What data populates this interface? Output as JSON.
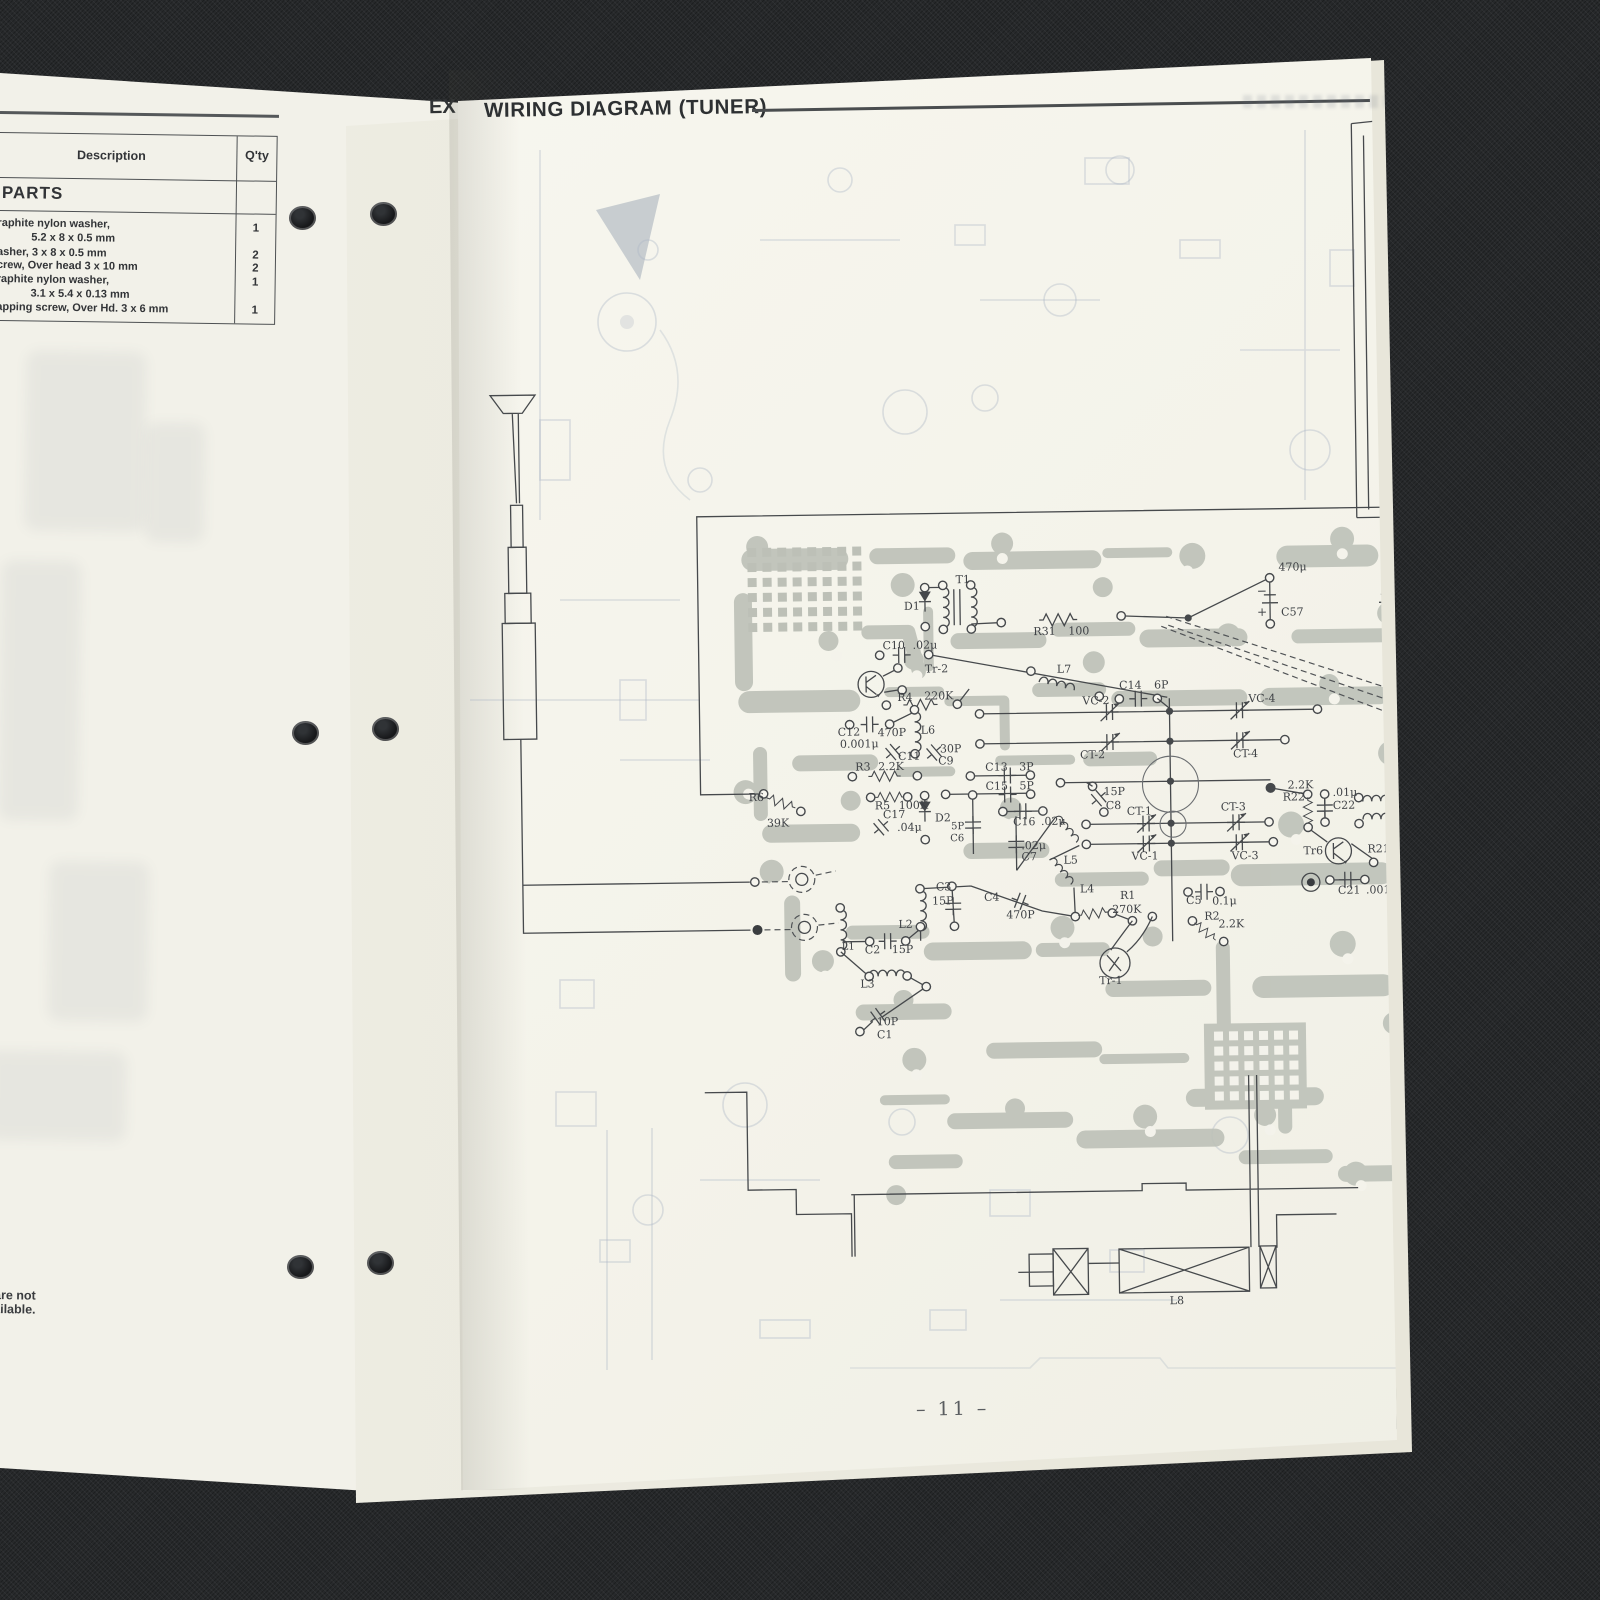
{
  "window": {
    "title": "WIRING DIAGRAM (TUNER)",
    "under_page_header_fragment": "EX",
    "page_number": "– 11 –"
  },
  "left_page": {
    "table": {
      "headers": {
        "description": "Description",
        "qty": "Q'ty"
      },
      "section": "PARTS",
      "rows": [
        {
          "d1": "raphite nylon washer,",
          "d2": "5.2 x 8 x 0.5 mm",
          "qty": "1"
        },
        {
          "d1": "asher, 3 x 8 x 0.5 mm",
          "d2": "",
          "qty": "2"
        },
        {
          "d1": "crew, Over head 3 x 10 mm",
          "d2": "",
          "qty": "2"
        },
        {
          "d1": "raphite nylon washer,",
          "d2": "3.1 x 5.4 x 0.13 mm",
          "qty": "1"
        },
        {
          "d1": "apping screw, Over Hd. 3 x 6 mm",
          "d2": "",
          "qty": "1"
        }
      ]
    },
    "footnote": "ty are not available."
  },
  "diagram": {
    "bottom_coil_label": "L8",
    "labels": [
      {
        "t": "T1",
        "x": 958,
        "y": 584
      },
      {
        "t": "D1",
        "x": 906,
        "y": 610
      },
      {
        "t": "R31",
        "x": 1035,
        "y": 637
      },
      {
        "t": "100",
        "x": 1070,
        "y": 637
      },
      {
        "t": "C10",
        "x": 884,
        "y": 649
      },
      {
        "t": ".02μ",
        "x": 914,
        "y": 649
      },
      {
        "t": "Tr-2",
        "x": 926,
        "y": 673
      },
      {
        "t": "R4",
        "x": 898,
        "y": 701
      },
      {
        "t": "220K",
        "x": 925,
        "y": 700
      },
      {
        "t": "C12",
        "x": 838,
        "y": 735
      },
      {
        "t": "0.001μ",
        "x": 840,
        "y": 747
      },
      {
        "t": "470P",
        "x": 878,
        "y": 736
      },
      {
        "t": "C11",
        "x": 898,
        "y": 760
      },
      {
        "t": "L6",
        "x": 921,
        "y": 734
      },
      {
        "t": "30P",
        "x": 940,
        "y": 753
      },
      {
        "t": "C9",
        "x": 938,
        "y": 765
      },
      {
        "t": "R3",
        "x": 855,
        "y": 770
      },
      {
        "t": "2.2K",
        "x": 878,
        "y": 770
      },
      {
        "t": "C13",
        "x": 985,
        "y": 772
      },
      {
        "t": "3P",
        "x": 1019,
        "y": 772
      },
      {
        "t": "C15",
        "x": 985,
        "y": 791
      },
      {
        "t": "5P",
        "x": 1019,
        "y": 791
      },
      {
        "t": "R5",
        "x": 874,
        "y": 809
      },
      {
        "t": "100K",
        "x": 898,
        "y": 809
      },
      {
        "t": "C17",
        "x": 882,
        "y": 818
      },
      {
        "t": ".04μ",
        "x": 896,
        "y": 831
      },
      {
        "t": "D2",
        "x": 934,
        "y": 822
      },
      {
        "t": "5P",
        "x": 950,
        "y": 830,
        "s": 10
      },
      {
        "t": "C6",
        "x": 949,
        "y": 842,
        "s": 10
      },
      {
        "t": "C16",
        "x": 1012,
        "y": 827
      },
      {
        "t": ".02μ",
        "x": 1040,
        "y": 827
      },
      {
        "t": ".02μ",
        "x": 1020,
        "y": 851
      },
      {
        "t": "C7",
        "x": 1020,
        "y": 862
      },
      {
        "t": "R6",
        "x": 748,
        "y": 799
      },
      {
        "t": "39K",
        "x": 766,
        "y": 825
      },
      {
        "t": "L7",
        "x": 1058,
        "y": 675
      },
      {
        "t": "C14",
        "x": 1120,
        "y": 692
      },
      {
        "t": "6P",
        "x": 1155,
        "y": 692
      },
      {
        "t": "VC-2",
        "x": 1083,
        "y": 707
      },
      {
        "t": "CT-2",
        "x": 1080,
        "y": 761
      },
      {
        "t": "VC-4",
        "x": 1249,
        "y": 707
      },
      {
        "t": "CT-4",
        "x": 1233,
        "y": 762
      },
      {
        "t": "15P",
        "x": 1103,
        "y": 798
      },
      {
        "t": "C8",
        "x": 1105,
        "y": 812
      },
      {
        "t": "CT-1",
        "x": 1126,
        "y": 818
      },
      {
        "t": "CT-3",
        "x": 1220,
        "y": 815
      },
      {
        "t": "VC-1",
        "x": 1130,
        "y": 863
      },
      {
        "t": "VC-3",
        "x": 1230,
        "y": 864
      },
      {
        "t": "2.2K",
        "x": 1287,
        "y": 794
      },
      {
        "t": "R22",
        "x": 1282,
        "y": 806
      },
      {
        "t": ".01μ",
        "x": 1332,
        "y": 802
      },
      {
        "t": "C22",
        "x": 1332,
        "y": 815
      },
      {
        "t": "L9",
        "x": 1394,
        "y": 813
      },
      {
        "t": "Tr6",
        "x": 1302,
        "y": 860
      },
      {
        "t": "R21",
        "x": 1366,
        "y": 859
      },
      {
        "t": "1.3M",
        "x": 1404,
        "y": 859
      },
      {
        "t": "C21",
        "x": 1336,
        "y": 900
      },
      {
        "t": ".0015μ",
        "x": 1364,
        "y": 900
      },
      {
        "t": "470μ",
        "x": 1281,
        "y": 576
      },
      {
        "t": "C57",
        "x": 1283,
        "y": 621
      },
      {
        "t": "−",
        "x": 1259,
        "y": 600,
        "s": 12
      },
      {
        "t": "+",
        "x": 1259,
        "y": 621,
        "s": 12
      },
      {
        "t": "– C58",
        "x": 1392,
        "y": 599
      },
      {
        "t": "+ 470",
        "x": 1392,
        "y": 617
      },
      {
        "t": "C3",
        "x": 934,
        "y": 891
      },
      {
        "t": "15P",
        "x": 930,
        "y": 905
      },
      {
        "t": "C4",
        "x": 982,
        "y": 902
      },
      {
        "t": "470P",
        "x": 1004,
        "y": 920
      },
      {
        "t": "L5",
        "x": 1062,
        "y": 866
      },
      {
        "t": "L4",
        "x": 1078,
        "y": 895
      },
      {
        "t": "R1",
        "x": 1118,
        "y": 902
      },
      {
        "t": "270K",
        "x": 1110,
        "y": 916
      },
      {
        "t": "C5",
        "x": 1184,
        "y": 908
      },
      {
        "t": "0.1μ",
        "x": 1210,
        "y": 909
      },
      {
        "t": "R2",
        "x": 1202,
        "y": 924
      },
      {
        "t": "2.2K",
        "x": 1216,
        "y": 932
      },
      {
        "t": "L2",
        "x": 896,
        "y": 928
      },
      {
        "t": "C2",
        "x": 862,
        "y": 953
      },
      {
        "t": "15P",
        "x": 889,
        "y": 953
      },
      {
        "t": "L1",
        "x": 839,
        "y": 949,
        "s": 10
      },
      {
        "t": "L3",
        "x": 857,
        "y": 987
      },
      {
        "t": "10P",
        "x": 873,
        "y": 1025
      },
      {
        "t": "C1",
        "x": 873,
        "y": 1038
      },
      {
        "t": "Tr-1",
        "x": 1096,
        "y": 987
      },
      {
        "t": "L8",
        "x": 1162,
        "y": 1308
      }
    ]
  }
}
